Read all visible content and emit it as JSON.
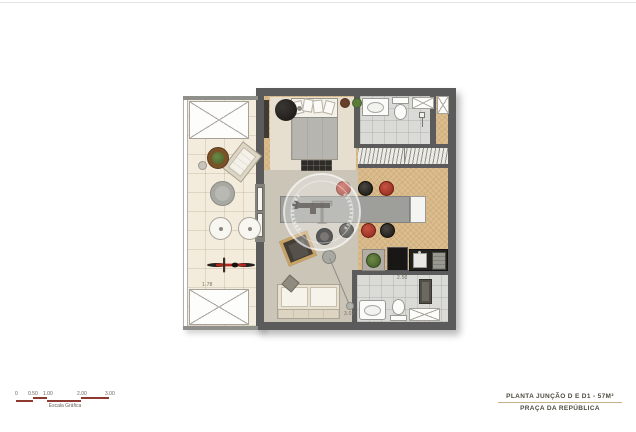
{
  "footer": {
    "title": "PLANTA JUNÇÃO D E D1 - 57M²",
    "subtitle": "PRAÇA DA REPÚBLICA"
  },
  "scale_bar": {
    "labels": [
      "0",
      "0.50",
      "1.00",
      "2.00",
      "3.00"
    ],
    "caption": "Escala Gráfica",
    "bar_color": "#8e3a31"
  },
  "watermark": {
    "monogram": "T"
  },
  "plan": {
    "dimensions": {
      "balcony_width": "1.78",
      "living_length": "3.02",
      "bathroom_width": "2.50"
    },
    "colors": {
      "wall": "#5b5b5b",
      "wood_floor": "#dcbd8e",
      "living_rug": "#cbc5b8",
      "balcony_tile": "#f3ecdc",
      "bath_tile": "#dadad6",
      "accent_red": "#b13a2c",
      "table_gray": "#9e9e9a",
      "footer_rule": "#c6b38e"
    }
  }
}
